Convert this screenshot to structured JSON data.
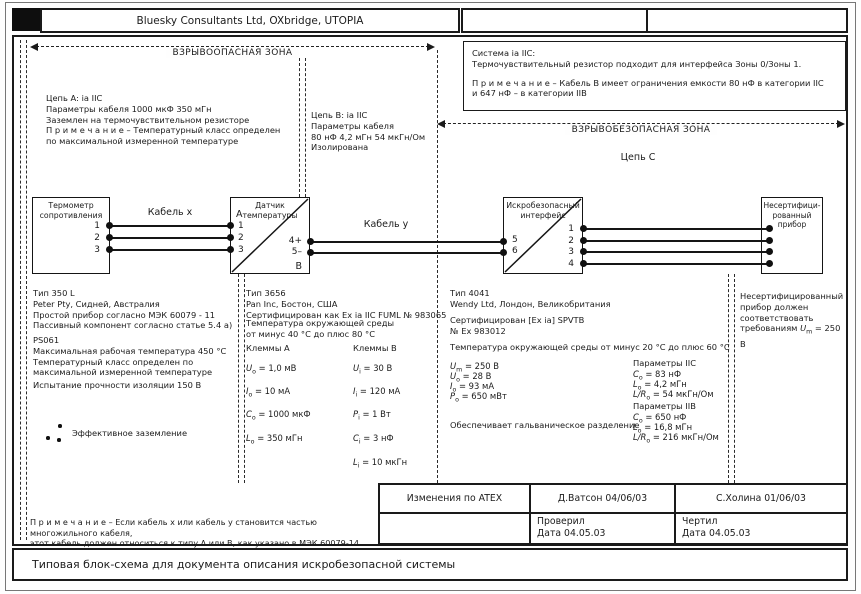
{
  "header": {
    "company_title": "Bluesky Consultants Ltd, OXbridge, UTOPIA"
  },
  "zones": {
    "hazardous": "ВЗРЫВООПАСНАЯ ЗОНА",
    "safe": "ВЗРЫВОБЕЗОПАСНАЯ ЗОНА"
  },
  "system_box": {
    "intro": [
      "Система ia IIC:",
      "Термочувствительный резистор подходит для интерфейса Зоны 0/Зоны 1."
    ],
    "note": [
      "П р и м е ч а н и е – Кабель В имеет ограничения емкости 80 нФ в категории IIC",
      "и 647 нФ – в категории IIB"
    ]
  },
  "circuits": {
    "a_note": [
      "Цепь А: ia IIC",
      "Параметры кабеля 1000 мкФ 350 мГн",
      "Заземлен на термочувствительном резисторе",
      "П р и м е ч а н и е – Температурный класс определен",
      "по максимальной измеренной температуре"
    ],
    "b_note": [
      "Цепь В: ia IIC",
      "Параметры кабеля",
      "80 нФ 4,2 мГн 54 мкГн/Ом",
      "Изолирована"
    ],
    "c_label": "Цепь С"
  },
  "cables": {
    "x_label": "Кабель x",
    "y_label": "Кабель y"
  },
  "devices": {
    "thermometer": {
      "name": [
        "Термометр",
        "сопротивления"
      ],
      "terminals": [
        "1",
        "2",
        "3"
      ]
    },
    "sensor": {
      "name": [
        "Датчик",
        "температуры"
      ],
      "corner_a": "А",
      "corner_b": "В",
      "left_terminals": [
        "1",
        "2",
        "3"
      ],
      "right_terminals": [
        "4+",
        "5–"
      ]
    },
    "interface": {
      "name": [
        "Искробезопасный",
        "интерфейс"
      ],
      "left_terminals": [
        "5",
        "6"
      ],
      "right_terminals": [
        "1",
        "2",
        "3",
        "4"
      ]
    },
    "uncertified": {
      "name": [
        "Несертифици-",
        "рованный",
        "прибор"
      ]
    }
  },
  "thermometer_specs": {
    "block1": [
      "Тип 350 L",
      "Peter Pty, Сидней, Австралия",
      "Простой прибор согласно МЭК 60079 - 11",
      "Пассивный компонент согласно статье 5.4 а)"
    ],
    "block2": [
      "PS061",
      "Максимальная рабочая температура 450 °C",
      "Температурный класс определен по",
      "максимальной измеренной температуре"
    ],
    "insulation": "Испытание прочности изоляции 150 В",
    "earth_label": "Эффективное заземление"
  },
  "sensor_specs": {
    "head": [
      "Тип 3656",
      "Pan Inc, Бостон, США",
      "Сертифицирован как Ex ia IIC FUML № 983065"
    ],
    "ambient": [
      "Температура окружающей среды",
      "от минус 40 °C до плюс 80 °C"
    ],
    "col_a_title": "Клеммы А",
    "col_b_title": "Клеммы В",
    "a": [
      {
        "s": "U",
        "b": "o",
        "r": " = 1,0 мВ"
      },
      {
        "s": "I",
        "b": "o",
        "r": " = 10 мА"
      },
      {
        "s": "C",
        "b": "o",
        "r": " = 1000 мкФ"
      },
      {
        "s": "L",
        "b": "o",
        "r": " = 350 мГн"
      }
    ],
    "b": [
      {
        "s": "U",
        "b": "i",
        "r": " = 30 В"
      },
      {
        "s": "I",
        "b": "i",
        "r": " = 120 мА"
      },
      {
        "s": "P",
        "b": "i",
        "r": " = 1 Вт"
      },
      {
        "s": "C",
        "b": "i",
        "r": " = 3 нФ"
      },
      {
        "s": "L",
        "b": "i",
        "r": " = 10 мкГн"
      }
    ]
  },
  "interface_specs": {
    "head": [
      "Тип 4041",
      "Wendy Ltd, Лондон, Великобритания"
    ],
    "cert": [
      "Сертифицирован [Ex ia] SPVTB",
      "№ Ex 983012"
    ],
    "ambient": "Температура окружающей среды от минус 20 °C до плюс 60 °C",
    "left": [
      {
        "s": "U",
        "b": "m",
        "r": " = 250 В"
      },
      {
        "s": "U",
        "b": "o",
        "r": " = 28 В"
      },
      {
        "s": "I",
        "b": "o",
        "r": " = 93 мА"
      },
      {
        "s": "P",
        "b": "o",
        "r": " = 650 мВт"
      }
    ],
    "iic_title": "Параметры IIC",
    "iic": [
      {
        "s": "C",
        "b": "o",
        "r": " = 83 нФ"
      },
      {
        "s": "L",
        "b": "o",
        "r": " = 4,2 мГн"
      },
      {
        "s": "L/R",
        "b": "o",
        "r": " = 54 мкГн/Ом"
      }
    ],
    "iib_title": "Параметры IIB",
    "iib": [
      {
        "s": "C",
        "b": "o",
        "r": " = 650 нФ"
      },
      {
        "s": "L",
        "b": "o",
        "r": " = 16,8 мГн"
      },
      {
        "s": "L/R",
        "b": "o",
        "r": " = 216 мкГн/Ом"
      }
    ],
    "galvanic": "Обеспечивает гальваническое разделение"
  },
  "uncertified_note": {
    "prefix": "Несертифицированный прибор должен соответствовать требованиям ",
    "um": {
      "s": "U",
      "b": "m",
      "r": " = 250 В"
    }
  },
  "footnote": [
    "П р и м е ч а н и е – Если кабель x или кабель y становится частью многожильного кабеля,",
    "этот кабель должен относиться к типу А или В, как указано в МЭК 60079-14."
  ],
  "title_block": {
    "r1": [
      "Изменения  по ATEX",
      "Д.Ватсон 04/06/03",
      "С.Холина 01/06/03"
    ],
    "r2c2": [
      "Проверил",
      "Дата 04.05.03"
    ],
    "r2c3": [
      "Чертил",
      "Дата 04.05.03"
    ]
  },
  "footer": {
    "caption": "Типовая блок-схема для документа описания искробезопасной системы"
  }
}
